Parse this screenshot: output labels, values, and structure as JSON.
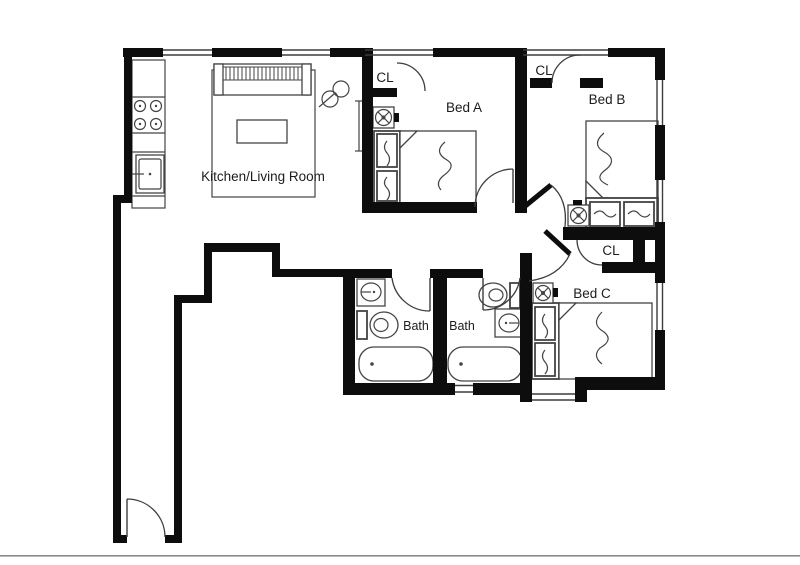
{
  "page": {
    "background": "#ffffff",
    "edge_color": "#8a8a8a"
  },
  "floorplan": {
    "colors": {
      "wall": "#0d0d0d",
      "line": "#3d3d3d",
      "furniture": "#444444",
      "text": "#1c1c1c"
    },
    "labels": {
      "kitchen_living": "Kitchen/Living Room",
      "bed_a": "Bed A",
      "bed_b": "Bed B",
      "bed_c": "Bed C",
      "bath_left": "Bath",
      "bath_right": "Bath",
      "closet_a": "CL",
      "closet_b": "CL",
      "closet_c": "CL"
    }
  }
}
